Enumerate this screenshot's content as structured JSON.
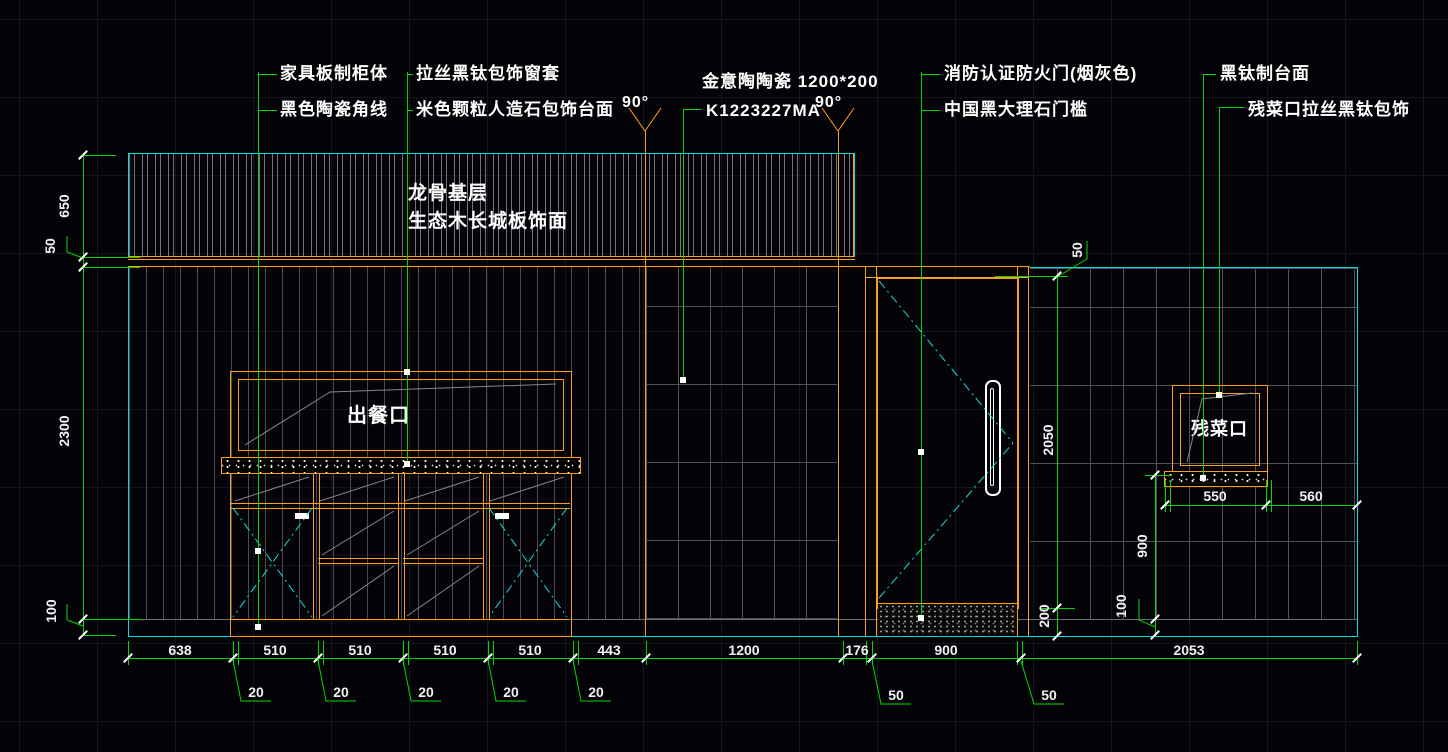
{
  "drawing": {
    "type": "cad-elevation",
    "background": "#030307",
    "colors": {
      "outline_cyan": "#00dede",
      "frame_orange": "#fa9f1e",
      "dimension_green": "#00d800",
      "text_white": "#ffffff",
      "panel_gray": "#51515b"
    }
  },
  "annotations": {
    "cabinet_label": "家具板制柜体",
    "corner_line_label": "黑色陶瓷角线",
    "window_casing_label": "拉丝黑钛包饰窗套",
    "stone_countertop_label": "米色颗粒人造石包饰台面",
    "tile_brand_label": "金意陶陶瓷 1200*200",
    "tile_model_label": "K1223227MA",
    "angle_left": "90°",
    "angle_right": "90°",
    "fire_door_label": "消防认证防火门(烟灰色)",
    "threshold_label": "中国黑大理石门槛",
    "black_titanium_top_label": "黑钛制台面",
    "waste_port_cladding_label": "残菜口拉丝黑钛包饰",
    "keel_base_label": "龙骨基层",
    "eco_wood_label": "生态木长城板饰面",
    "serving_window_label": "出餐口",
    "waste_window_label": "残菜口"
  },
  "dimensions": {
    "bottom": [
      "638",
      "510",
      "510",
      "510",
      "510",
      "443",
      "1200",
      "176",
      "900",
      "2053"
    ],
    "bottom_offsets_20": [
      "20",
      "20",
      "20",
      "20",
      "20"
    ],
    "bottom_offsets_50": [
      "50",
      "50"
    ],
    "left": {
      "top_band": "650",
      "gap": "50",
      "main": "2300",
      "base": "100"
    },
    "door": {
      "top_gap": "50",
      "height": "2050",
      "threshold": "200"
    },
    "waste_side": {
      "counter_height": "900",
      "base": "100",
      "window_width": "550",
      "right_offset": "560"
    }
  }
}
